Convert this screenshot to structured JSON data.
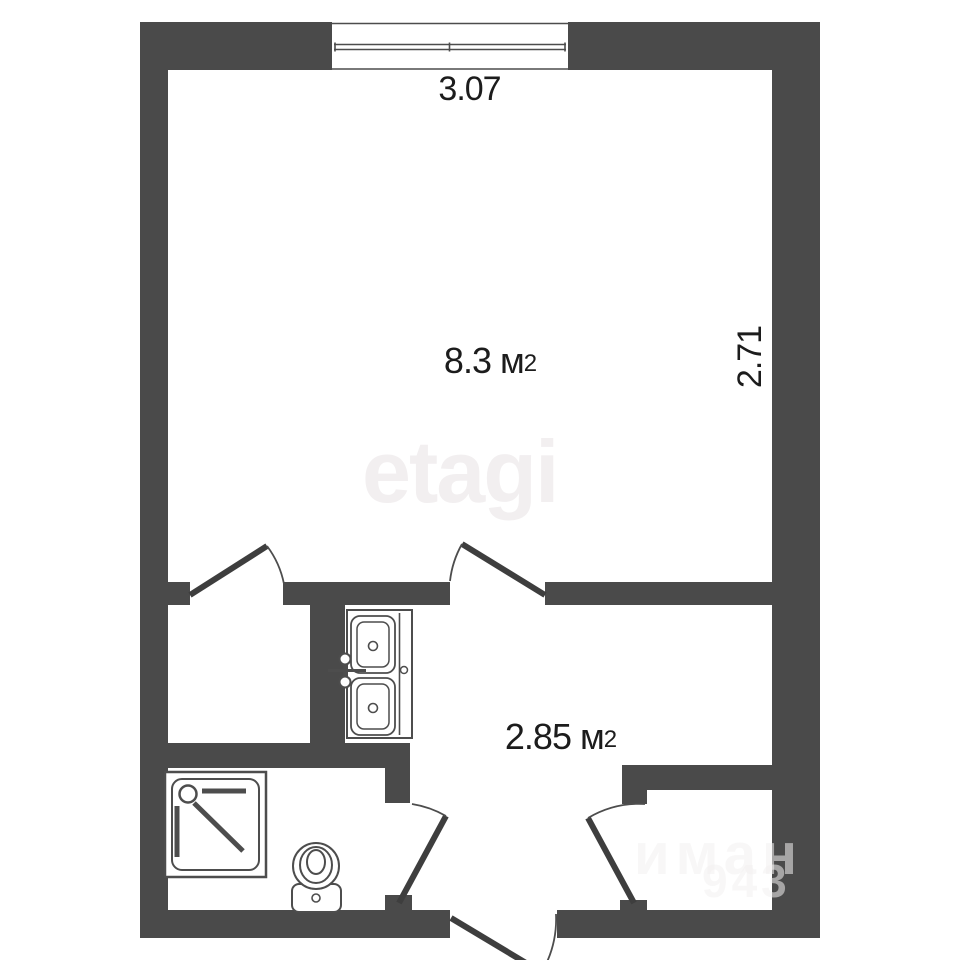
{
  "colors": {
    "bg": "#ffffff",
    "wall": "#4a4a4a",
    "line": "#4d4d4d",
    "leaf": "#3e3e3e",
    "text": "#1c1c1c",
    "watermark": "#f2eff0",
    "watermark2": "rgba(242,240,240,0.55)"
  },
  "dimensions": {
    "top": "3.07",
    "right": "2.71"
  },
  "rooms": [
    {
      "name": "main-room",
      "area_value": "8.3",
      "area_unit": "м",
      "area_sup": "2"
    },
    {
      "name": "hallway-kitchen",
      "area_value": "2.85",
      "area_unit": "м",
      "area_sup": "2"
    }
  ],
  "watermarks": {
    "brand": "etagi",
    "corner_line1": "иман",
    "corner_line2": "943"
  },
  "fixtures": [
    {
      "name": "window"
    },
    {
      "name": "double-sink"
    },
    {
      "name": "shower-tray"
    },
    {
      "name": "toilet"
    },
    {
      "name": "door-swing-main-to-leftroom"
    },
    {
      "name": "door-swing-main-to-hallway"
    },
    {
      "name": "door-swing-bathroom"
    },
    {
      "name": "door-swing-niche"
    },
    {
      "name": "door-swing-entrance"
    }
  ]
}
